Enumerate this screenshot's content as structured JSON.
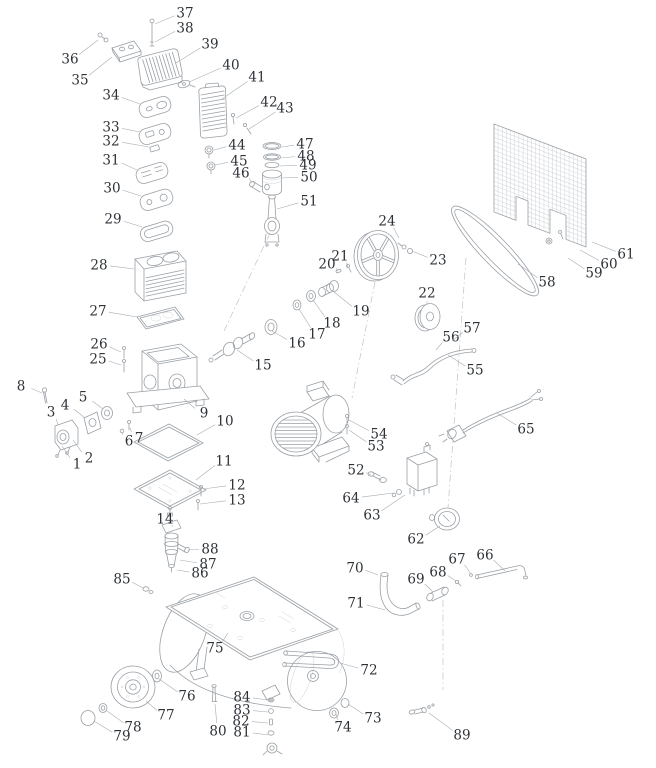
{
  "style": {
    "line_color": "#9aa0a6",
    "light_line_color": "#c9ced3",
    "ink_color": "#2d3237",
    "background": "#ffffff"
  },
  "diagram": {
    "type": "exploded-parts-diagram",
    "part_count": 89,
    "parts": [
      {
        "n": "1",
        "x": 77,
        "y": 464,
        "tx": 62,
        "ty": 446
      },
      {
        "n": "2",
        "x": 89,
        "y": 458,
        "tx": 73,
        "ty": 440
      },
      {
        "n": "3",
        "x": 51,
        "y": 412,
        "tx": 58,
        "ty": 425
      },
      {
        "n": "4",
        "x": 65,
        "y": 405,
        "tx": 85,
        "ty": 418
      },
      {
        "n": "5",
        "x": 83,
        "y": 397,
        "tx": 103,
        "ty": 409
      },
      {
        "n": "6",
        "x": 129,
        "y": 441,
        "tx": 123,
        "ty": 433
      },
      {
        "n": "7",
        "x": 139,
        "y": 438,
        "tx": 130,
        "ty": 428
      },
      {
        "n": "8",
        "x": 21,
        "y": 386,
        "tx": 42,
        "ty": 393
      },
      {
        "n": "9",
        "x": 204,
        "y": 413,
        "tx": 184,
        "ty": 399
      },
      {
        "n": "10",
        "x": 225,
        "y": 421,
        "tx": 197,
        "ty": 435
      },
      {
        "n": "11",
        "x": 224,
        "y": 461,
        "tx": 196,
        "ty": 480
      },
      {
        "n": "12",
        "x": 237,
        "y": 485,
        "tx": 203,
        "ty": 489
      },
      {
        "n": "13",
        "x": 237,
        "y": 500,
        "tx": 200,
        "ty": 504
      },
      {
        "n": "14",
        "x": 165,
        "y": 519,
        "tx": 172,
        "ty": 527
      },
      {
        "n": "15",
        "x": 263,
        "y": 365,
        "tx": 237,
        "ty": 350
      },
      {
        "n": "16",
        "x": 297,
        "y": 343,
        "tx": 272,
        "ty": 331
      },
      {
        "n": "17",
        "x": 317,
        "y": 334,
        "tx": 299,
        "ty": 309
      },
      {
        "n": "18",
        "x": 332,
        "y": 323,
        "tx": 313,
        "ty": 300
      },
      {
        "n": "19",
        "x": 361,
        "y": 311,
        "tx": 334,
        "ty": 292
      },
      {
        "n": "20",
        "x": 327,
        "y": 264,
        "tx": 338,
        "ty": 271
      },
      {
        "n": "21",
        "x": 340,
        "y": 256,
        "tx": 348,
        "ty": 267
      },
      {
        "n": "22",
        "x": 427,
        "y": 293,
        "tx": 427,
        "ty": 305
      },
      {
        "n": "23",
        "x": 438,
        "y": 260,
        "tx": 412,
        "ty": 251
      },
      {
        "n": "24",
        "x": 387,
        "y": 221,
        "tx": 399,
        "ty": 238
      },
      {
        "n": "25",
        "x": 98,
        "y": 359,
        "tx": 121,
        "ty": 365
      },
      {
        "n": "26",
        "x": 99,
        "y": 344,
        "tx": 121,
        "ty": 352
      },
      {
        "n": "27",
        "x": 98,
        "y": 311,
        "tx": 137,
        "ty": 317
      },
      {
        "n": "28",
        "x": 99,
        "y": 265,
        "tx": 134,
        "ty": 269
      },
      {
        "n": "29",
        "x": 113,
        "y": 219,
        "tx": 142,
        "ty": 227
      },
      {
        "n": "30",
        "x": 112,
        "y": 188,
        "tx": 141,
        "ty": 196
      },
      {
        "n": "31",
        "x": 111,
        "y": 160,
        "tx": 137,
        "ty": 170
      },
      {
        "n": "32",
        "x": 111,
        "y": 141,
        "tx": 149,
        "ty": 147
      },
      {
        "n": "33",
        "x": 111,
        "y": 127,
        "tx": 140,
        "ty": 132
      },
      {
        "n": "34",
        "x": 111,
        "y": 95,
        "tx": 140,
        "ty": 104
      },
      {
        "n": "35",
        "x": 80,
        "y": 80,
        "tx": 112,
        "ty": 57
      },
      {
        "n": "36",
        "x": 70,
        "y": 59,
        "tx": 98,
        "ty": 40
      },
      {
        "n": "37",
        "x": 185,
        "y": 13,
        "tx": 155,
        "ty": 24
      },
      {
        "n": "38",
        "x": 185,
        "y": 28,
        "tx": 155,
        "ty": 42
      },
      {
        "n": "39",
        "x": 210,
        "y": 44,
        "tx": 176,
        "ty": 63
      },
      {
        "n": "40",
        "x": 231,
        "y": 65,
        "tx": 189,
        "ty": 82
      },
      {
        "n": "41",
        "x": 257,
        "y": 77,
        "tx": 222,
        "ty": 99
      },
      {
        "n": "42",
        "x": 269,
        "y": 102,
        "tx": 236,
        "ty": 118
      },
      {
        "n": "43",
        "x": 285,
        "y": 108,
        "tx": 249,
        "ty": 129
      },
      {
        "n": "44",
        "x": 237,
        "y": 145,
        "tx": 214,
        "ty": 150
      },
      {
        "n": "45",
        "x": 239,
        "y": 161,
        "tx": 215,
        "ty": 165
      },
      {
        "n": "46",
        "x": 241,
        "y": 173,
        "tx": 252,
        "ty": 183
      },
      {
        "n": "47",
        "x": 305,
        "y": 144,
        "tx": 282,
        "ty": 147
      },
      {
        "n": "48",
        "x": 306,
        "y": 156,
        "tx": 281,
        "ty": 158
      },
      {
        "n": "49",
        "x": 308,
        "y": 165,
        "tx": 280,
        "ty": 166
      },
      {
        "n": "50",
        "x": 309,
        "y": 177,
        "tx": 282,
        "ty": 178
      },
      {
        "n": "51",
        "x": 309,
        "y": 201,
        "tx": 277,
        "ty": 209
      },
      {
        "n": "52",
        "x": 356,
        "y": 470,
        "tx": 371,
        "ty": 475
      },
      {
        "n": "53",
        "x": 376,
        "y": 446,
        "tx": 349,
        "ty": 430
      },
      {
        "n": "54",
        "x": 379,
        "y": 434,
        "tx": 349,
        "ty": 420
      },
      {
        "n": "55",
        "x": 475,
        "y": 370,
        "tx": 448,
        "ty": 355
      },
      {
        "n": "56",
        "x": 451,
        "y": 337,
        "tx": 436,
        "ty": 350
      },
      {
        "n": "57",
        "x": 472,
        "y": 328,
        "tx": 452,
        "ty": 341
      },
      {
        "n": "58",
        "x": 547,
        "y": 282,
        "tx": 518,
        "ty": 264
      },
      {
        "n": "59",
        "x": 594,
        "y": 273,
        "tx": 568,
        "ty": 258
      },
      {
        "n": "60",
        "x": 609,
        "y": 264,
        "tx": 580,
        "ty": 250
      },
      {
        "n": "61",
        "x": 626,
        "y": 254,
        "tx": 592,
        "ty": 242
      },
      {
        "n": "62",
        "x": 416,
        "y": 539,
        "tx": 440,
        "ty": 526
      },
      {
        "n": "63",
        "x": 372,
        "y": 515,
        "tx": 405,
        "ty": 495
      },
      {
        "n": "64",
        "x": 351,
        "y": 498,
        "tx": 393,
        "ty": 493
      },
      {
        "n": "65",
        "x": 526,
        "y": 429,
        "tx": 497,
        "ty": 413
      },
      {
        "n": "66",
        "x": 485,
        "y": 555,
        "tx": 505,
        "ty": 571
      },
      {
        "n": "67",
        "x": 457,
        "y": 559,
        "tx": 471,
        "ty": 574
      },
      {
        "n": "68",
        "x": 438,
        "y": 572,
        "tx": 456,
        "ty": 581
      },
      {
        "n": "69",
        "x": 416,
        "y": 579,
        "tx": 433,
        "ty": 592
      },
      {
        "n": "70",
        "x": 355,
        "y": 568,
        "tx": 378,
        "ty": 575
      },
      {
        "n": "71",
        "x": 356,
        "y": 603,
        "tx": 385,
        "ty": 610
      },
      {
        "n": "72",
        "x": 369,
        "y": 670,
        "tx": 340,
        "ty": 663
      },
      {
        "n": "73",
        "x": 373,
        "y": 718,
        "tx": 348,
        "ty": 704
      },
      {
        "n": "74",
        "x": 343,
        "y": 727,
        "tx": 336,
        "ty": 714
      },
      {
        "n": "75",
        "x": 215,
        "y": 648,
        "tx": 228,
        "ty": 633
      },
      {
        "n": "76",
        "x": 187,
        "y": 696,
        "tx": 159,
        "ty": 679
      },
      {
        "n": "77",
        "x": 166,
        "y": 715,
        "tx": 146,
        "ty": 701
      },
      {
        "n": "78",
        "x": 133,
        "y": 727,
        "tx": 107,
        "ty": 711
      },
      {
        "n": "79",
        "x": 122,
        "y": 736,
        "tx": 94,
        "ty": 721
      },
      {
        "n": "80",
        "x": 218,
        "y": 731,
        "tx": 215,
        "ty": 704
      },
      {
        "n": "81",
        "x": 242,
        "y": 732,
        "tx": 268,
        "ty": 735
      },
      {
        "n": "82",
        "x": 241,
        "y": 721,
        "tx": 268,
        "ty": 723
      },
      {
        "n": "83",
        "x": 242,
        "y": 710,
        "tx": 268,
        "ty": 712
      },
      {
        "n": "84",
        "x": 242,
        "y": 697,
        "tx": 268,
        "ty": 700
      },
      {
        "n": "85",
        "x": 122,
        "y": 579,
        "tx": 143,
        "ty": 588
      },
      {
        "n": "86",
        "x": 200,
        "y": 573,
        "tx": 177,
        "ty": 570
      },
      {
        "n": "87",
        "x": 208,
        "y": 564,
        "tx": 180,
        "ty": 560
      },
      {
        "n": "88",
        "x": 210,
        "y": 549,
        "tx": 188,
        "ty": 550
      },
      {
        "n": "89",
        "x": 462,
        "y": 735,
        "tx": 429,
        "ty": 713
      }
    ]
  }
}
